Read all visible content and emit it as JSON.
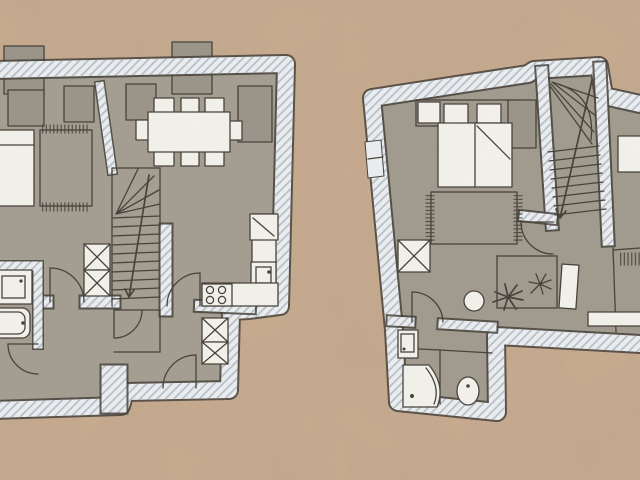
{
  "document": {
    "kind": "scanned-floor-plan-sketch",
    "plans": [
      {
        "id": "ground-floor",
        "position": "left",
        "rooms": [
          "living-room",
          "dining-room",
          "kitchen",
          "hallway",
          "bathroom",
          "staircase"
        ],
        "furniture": [
          "bed",
          "rug-fringed",
          "wall-cabinet",
          "chimney-blocks",
          "dining-table",
          "dining-chairs-8",
          "sideboard-left",
          "sideboard-right",
          "winder-staircase",
          "wardrobe-x2",
          "tall-cabinets-x2",
          "kitchen-counter",
          "fridge-cabinet",
          "sink-unit",
          "stove-4-burner",
          "bathtub",
          "washbasin-counter",
          "entrance-door-arc",
          "interior-door-arcs"
        ]
      },
      {
        "id": "upper-floor",
        "position": "right",
        "rooms": [
          "bedroom",
          "hallway",
          "bathroom",
          "staircase",
          "side-room"
        ],
        "furniture": [
          "double-bed",
          "pillows-2",
          "nightstand",
          "headboard-shelf",
          "wardrobe-x",
          "rug-fringed",
          "round-stool",
          "potted-plants-2",
          "plant-table",
          "shower-quarter",
          "toilet",
          "washbasin",
          "winder-staircase",
          "open-door-leaf",
          "radiator",
          "window-bench",
          "side-bed",
          "door-arcs"
        ]
      }
    ]
  },
  "colors": {
    "bg": "#c9ac90",
    "floor": "#a49e92",
    "floor2": "#a19b8f",
    "wall": "#edf0f3",
    "hatch": "#b6c0ca",
    "pencil": "#44403a",
    "white": "#f4f4ee",
    "grey": "#9a948a"
  }
}
